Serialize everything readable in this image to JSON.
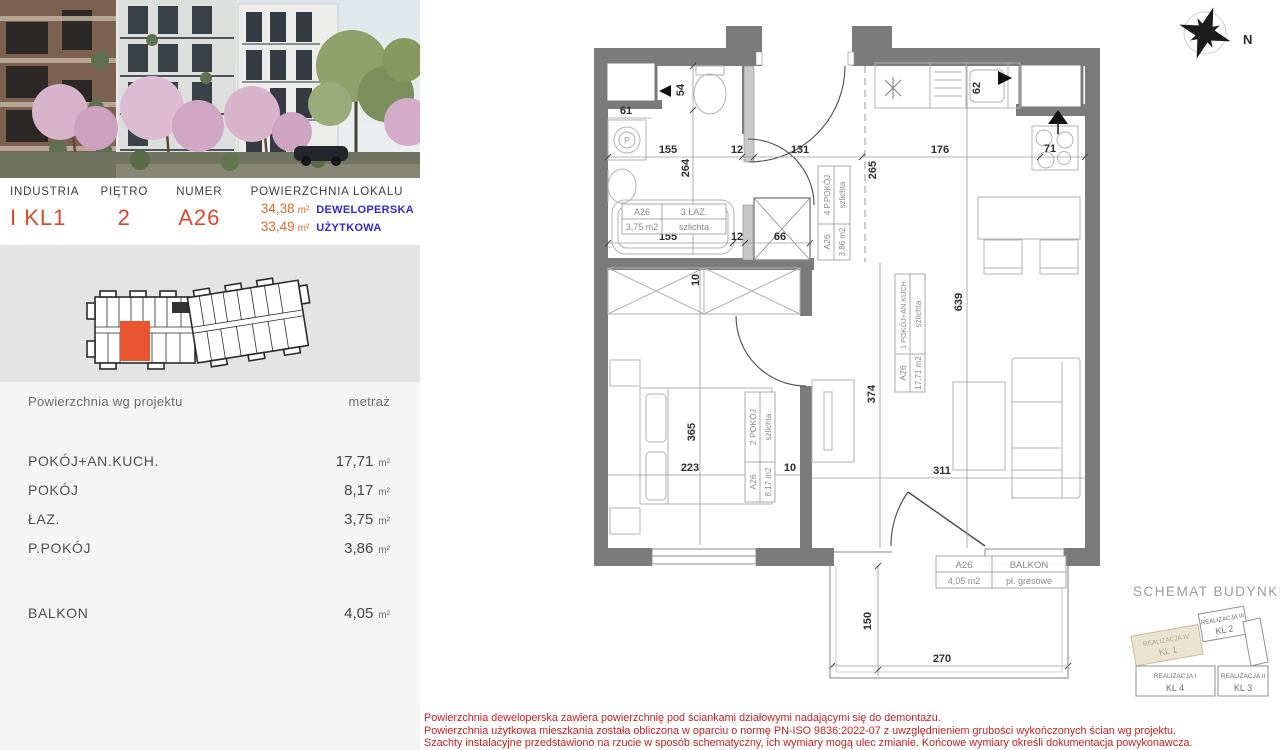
{
  "sidebar": {
    "info": {
      "col1_label": "INDUSTRIA",
      "col1_value": "I KL1",
      "col2_label": "PIĘTRO",
      "col2_value": "2",
      "col3_label": "NUMER",
      "col3_value": "A26",
      "col4_label": "POWIERZCHNIA LOKALU",
      "area_dev": "34,38",
      "area_dev_unit": "m²",
      "area_dev_type": "DEWELOPERSKA",
      "area_use": "33,49",
      "area_use_unit": "m²",
      "area_use_type": "UŻYTKOWA"
    },
    "table": {
      "header_left": "Powierzchnia wg projektu",
      "header_right": "metraż",
      "rows": [
        {
          "label": "POKÓJ+AN.KUCH.",
          "value": "17,71",
          "unit": "m²"
        },
        {
          "label": "POKÓJ",
          "value": "8,17",
          "unit": "m²"
        },
        {
          "label": "ŁAZ.",
          "value": "3,75",
          "unit": "m²"
        },
        {
          "label": "P.POKÓJ",
          "value": "3,86",
          "unit": "m²"
        }
      ],
      "balcony_row": {
        "label": "BALKON",
        "value": "4,05",
        "unit": "m²"
      }
    }
  },
  "plan": {
    "compass_label": "N",
    "symbols": {
      "washer": "P"
    },
    "rooms": {
      "bathroom": {
        "unit": "A26",
        "name": "3 ŁAZ.",
        "area": "3,75 m2",
        "finish": "szlichta"
      },
      "hall": {
        "unit": "A26",
        "name": "4 P.POKÓJ",
        "area": "3,86 m2",
        "finish": "szlichta"
      },
      "living": {
        "unit": "A26",
        "name": "1 POKÓJ+AN.KUCH.",
        "area": "17,71 m2",
        "finish": "szlichta"
      },
      "bedroom": {
        "unit": "A26",
        "name": "2 POKÓJ",
        "area": "8,17 m2",
        "finish": "szlichta"
      },
      "balcony": {
        "unit": "A26",
        "name": "BALKON",
        "area": "4,05 m2",
        "finish": "pł. gresowe"
      }
    },
    "dims": {
      "d54": "54",
      "d61": "61",
      "d155a": "155",
      "d12a": "12",
      "d131": "131",
      "d176": "176",
      "d62": "62",
      "d71": "71",
      "d264": "264",
      "d265": "265",
      "d155b": "155",
      "d12b": "12",
      "d66": "66",
      "d10a": "10",
      "d639": "639",
      "d374": "374",
      "d365": "365",
      "d223": "223",
      "d10b": "10",
      "d311": "311",
      "d150": "150",
      "d270": "270"
    }
  },
  "schemat": {
    "title": "SCHEMAT BUDYNKU",
    "segments": [
      {
        "line1": "REALIZACJA IV",
        "line2": "KL 1"
      },
      {
        "line1": "REALIZACJA III",
        "line2": "KL 2"
      },
      {
        "line1": "REALIZACJA II",
        "line2": "KL 3"
      },
      {
        "line1": "REALIZACJA I",
        "line2": "KL 4"
      }
    ]
  },
  "disclaimer": {
    "line1": "Powierzchnia deweloperska zawiera powierzchnię pod ściankami działowymi nadającymi się do demontażu.",
    "line2": "Powierzchnia użytkowa mieszkania została obliczona w oparciu o normę PN-ISO 9836:2022-07 z uwzględnieniem grubości wykończonych ścian wg projektu.",
    "line3": "Szachty instalacyjne przedstawiono na rzucie w sposób schematyczny, ich wymiary mogą ulec zmianie. Końcowe wymiary określi dokumentacja powykonawcza."
  },
  "colors": {
    "accent_red": "#d8492b",
    "accent_orange": "#e06a2c",
    "accent_blue": "#2b2bd0",
    "wall_gray": "#7b7b7b",
    "unit_highlight": "#e8542e",
    "disclaimer_red": "#c61f1f"
  }
}
